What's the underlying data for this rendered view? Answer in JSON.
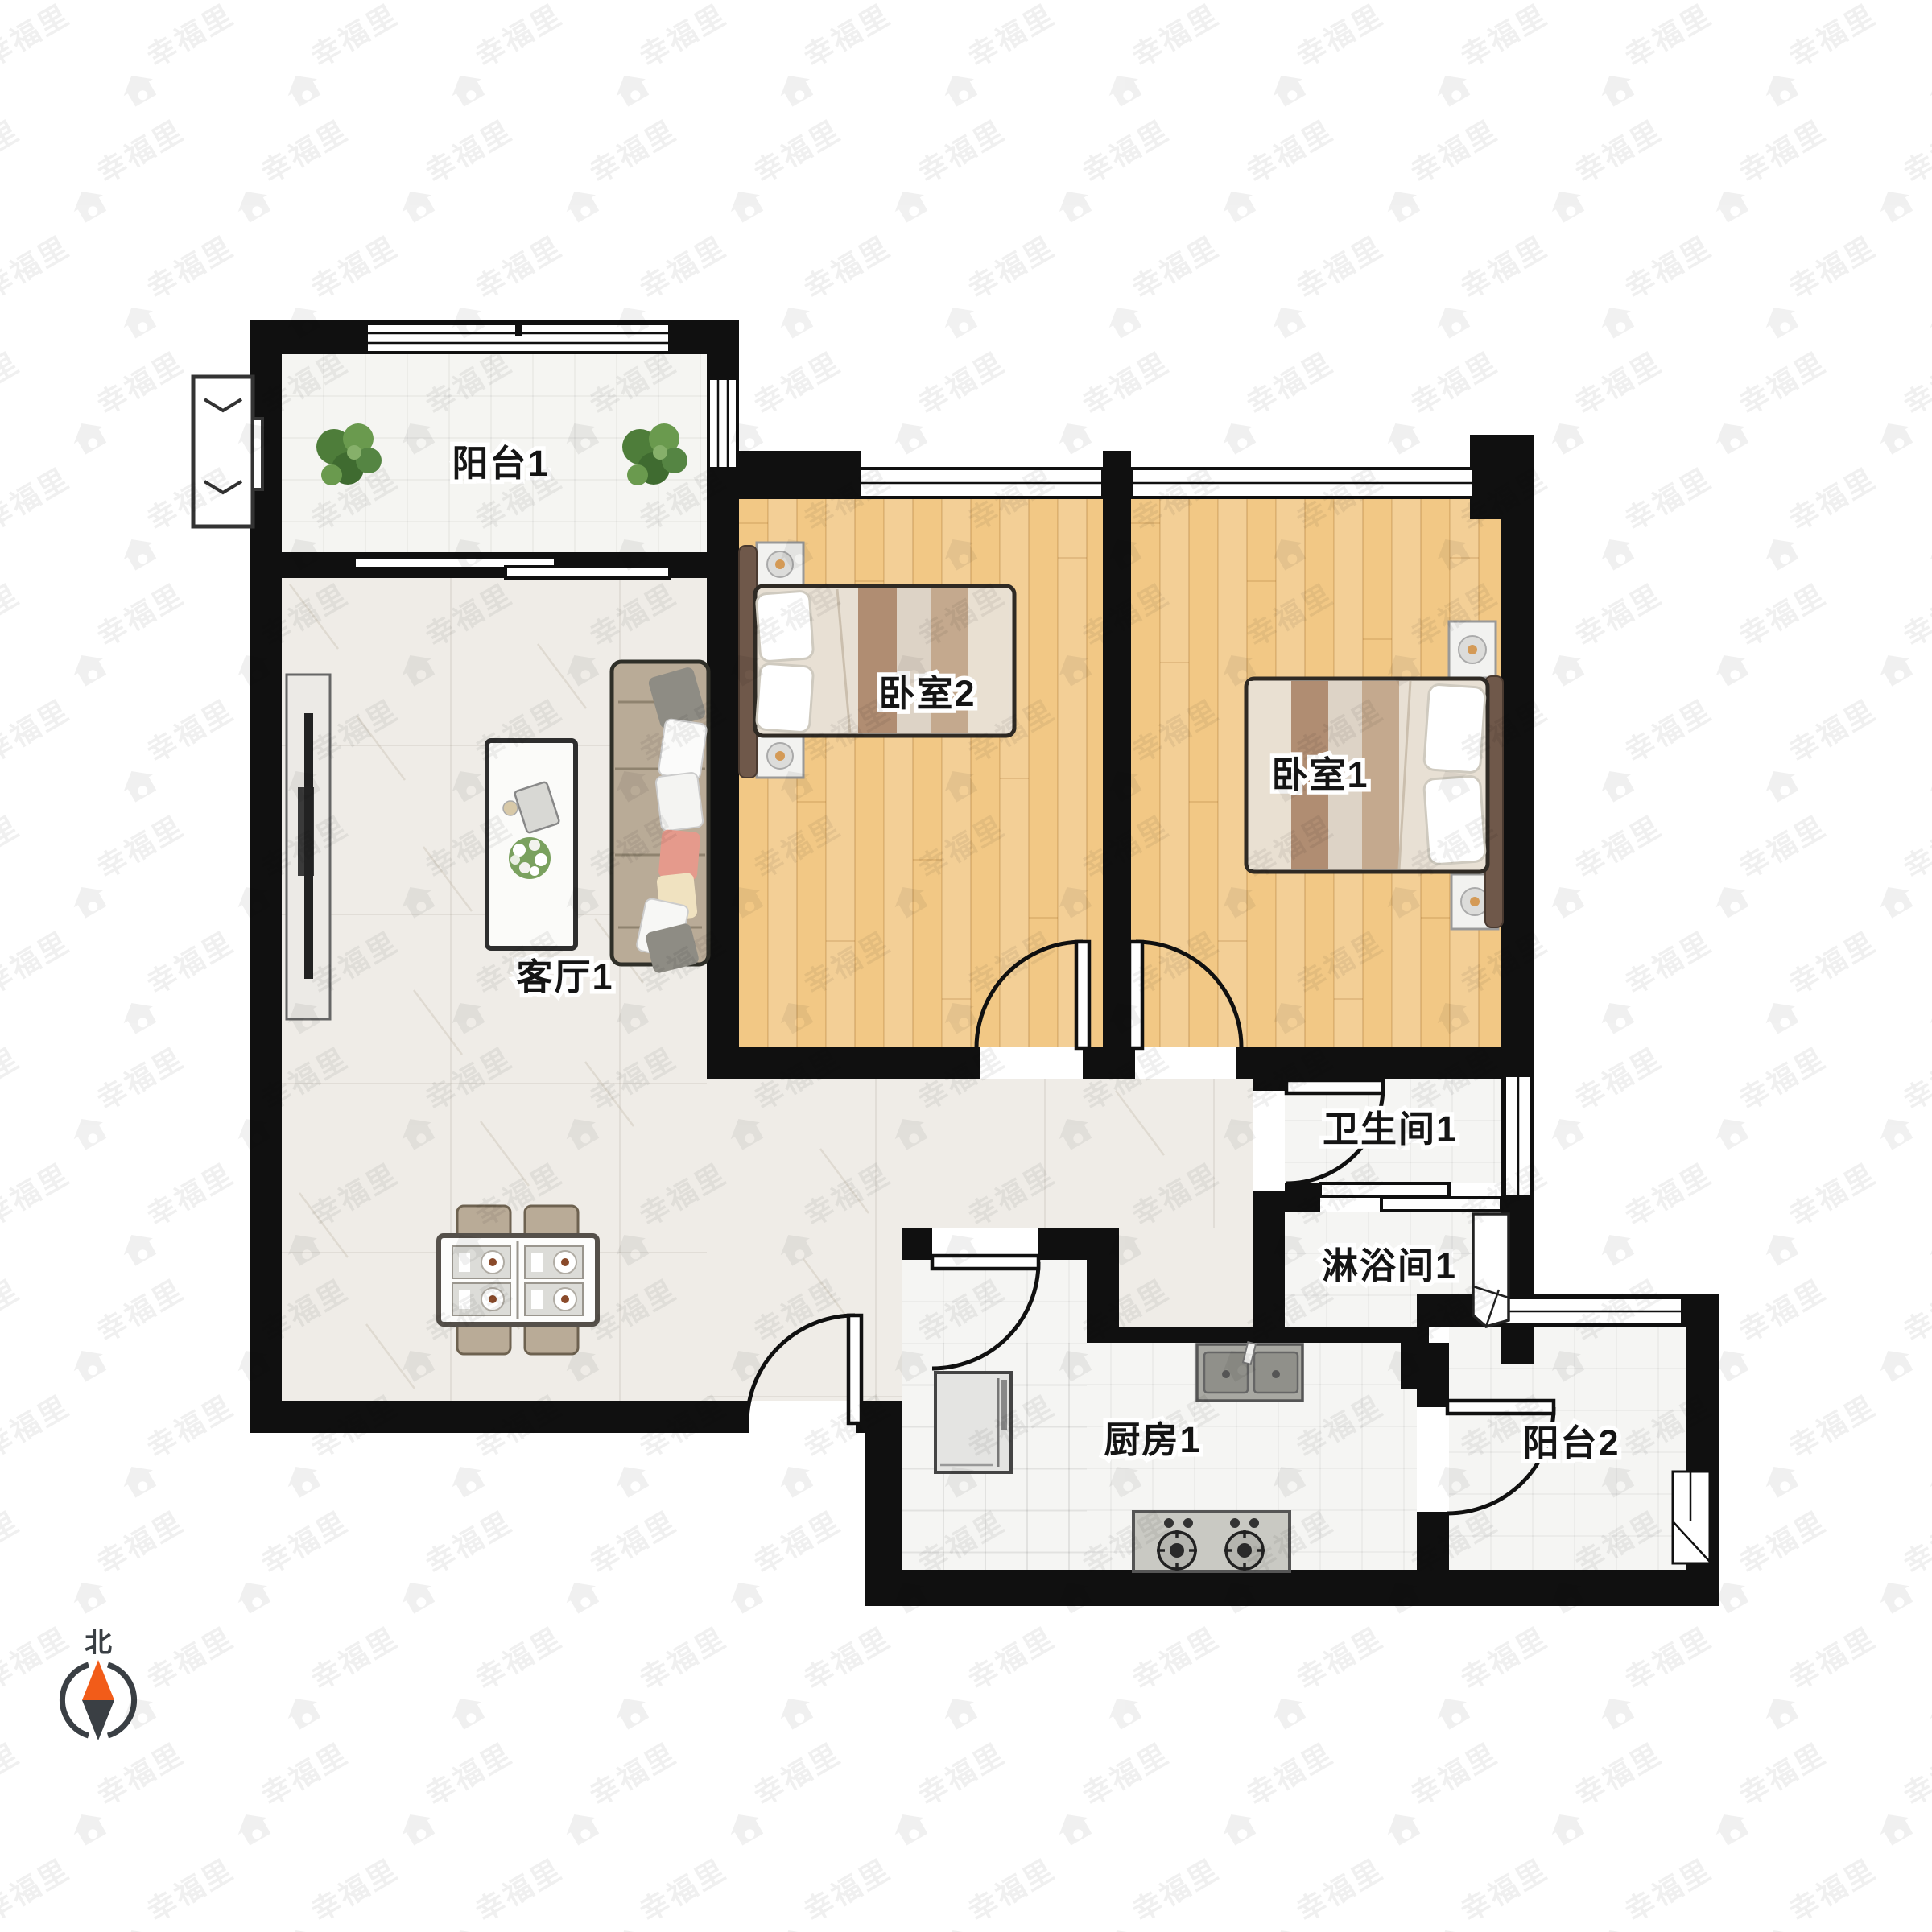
{
  "watermark": {
    "text": "幸福里",
    "icon": "house-icon",
    "color": "#000000",
    "opacity": 0.055
  },
  "compass": {
    "north_label": "北",
    "needle_north_color": "#f25c19",
    "needle_south_color": "#3a3f44"
  },
  "rooms": {
    "balcony1": {
      "label": "阳台1"
    },
    "bedroom2": {
      "label": "卧室2"
    },
    "bedroom1": {
      "label": "卧室1"
    },
    "living": {
      "label": "客厅1"
    },
    "bathroom": {
      "label": "卫生间1"
    },
    "shower": {
      "label": "淋浴间1"
    },
    "kitchen": {
      "label": "厨房1"
    },
    "balcony2": {
      "label": "阳台2"
    }
  },
  "colors": {
    "wall": "#101010",
    "wood_floor": "#f2c885",
    "marble_floor": "#efece7",
    "tile_floor": "#f5f5f3",
    "sofa": "#b9ab97",
    "bed_headboard": "#6f584a",
    "blanket_dark": "#b08d72",
    "blanket_light": "#ddd3c6",
    "plant_green": "#4e7d3a",
    "pillow_salmon": "#e59a8c",
    "pillow_cream": "#f0e2c0"
  }
}
